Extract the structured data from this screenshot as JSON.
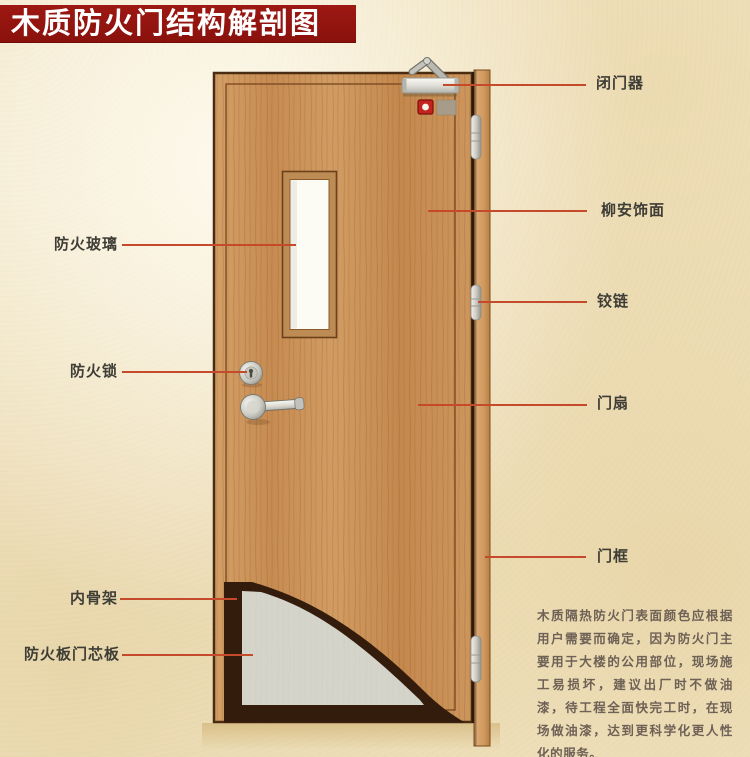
{
  "title": "木质防火门结构解剖图",
  "diagram": {
    "subject": "wooden fire door cutaway",
    "right_labels": [
      {
        "part": "door-closer",
        "text": "闭门器"
      },
      {
        "part": "lauan-veneer",
        "text": "柳安饰面"
      },
      {
        "part": "hinge",
        "text": "铰链"
      },
      {
        "part": "door-leaf",
        "text": "门扇"
      },
      {
        "part": "door-frame",
        "text": "门框"
      }
    ],
    "left_labels": [
      {
        "part": "fire-glass",
        "text": "防火玻璃"
      },
      {
        "part": "fire-lock",
        "text": "防火锁"
      },
      {
        "part": "inner-skeleton",
        "text": "内骨架"
      },
      {
        "part": "fire-board-core",
        "text": "防火板门芯板"
      }
    ],
    "note": "木质隔热防火门表面颜色应根据用户需要而确定，因为防火门主要用于大楼的公用部位，现场施工易损坏，建议出厂时不做油漆，待工程全面快完工时，在现场做油漆，达到更科学化更人性化的服务。",
    "colors": {
      "banner": "#8a110c",
      "leader_line": "#c5492b",
      "label_text": "#3e3d36",
      "note_text": "#6e6156",
      "door_wood": "#c98f58",
      "core_board": "#d4d4cb",
      "background": "#f2e7c9"
    }
  }
}
